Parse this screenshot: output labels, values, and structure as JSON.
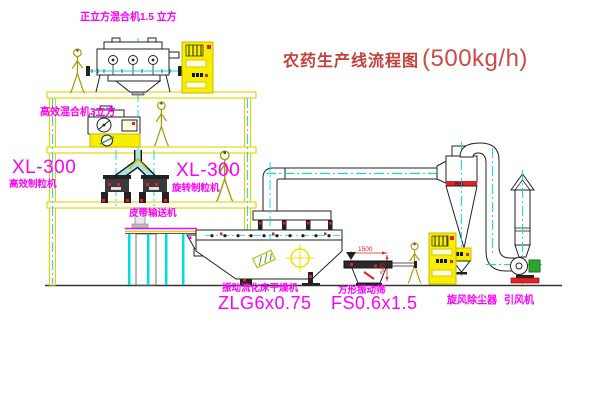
{
  "diagram": {
    "title": {
      "name": "农药生产线流程图",
      "capacity": "(500kg/h)"
    },
    "equipment": {
      "top_mixer": {
        "label": "正立方混合机1.5 立方"
      },
      "second_mixer": {
        "label": "高效混合机3立方"
      },
      "granulator_left": {
        "model": "XL-300",
        "name": "高效制粒机"
      },
      "granulator_right": {
        "model": "XL-300",
        "name": "旋转制粒机"
      },
      "belt_conveyor": {
        "name": "皮带输送机"
      },
      "fluid_bed_dryer": {
        "name": "振动流化床干燥机",
        "model": "ZLG6x0.75"
      },
      "vibrating_screen": {
        "name": "方形振动筛",
        "model": "FS0.6x1.5"
      },
      "cyclone": {
        "name": "旋风除尘器",
        "band_text": "800"
      },
      "fan": {
        "name": "引风机"
      }
    },
    "dimensions": {
      "screen_length": "1500",
      "screen_height": "545"
    },
    "colors": {
      "structure_yellow": "#e0d400",
      "cabinet_yellow": "#f8ee00",
      "text_magenta": "#ff00ff",
      "centerline_cyan": "#00dede",
      "accent_red": "#e02222",
      "title_red": "#c4413b",
      "motor_green": "#2fa52f"
    }
  }
}
